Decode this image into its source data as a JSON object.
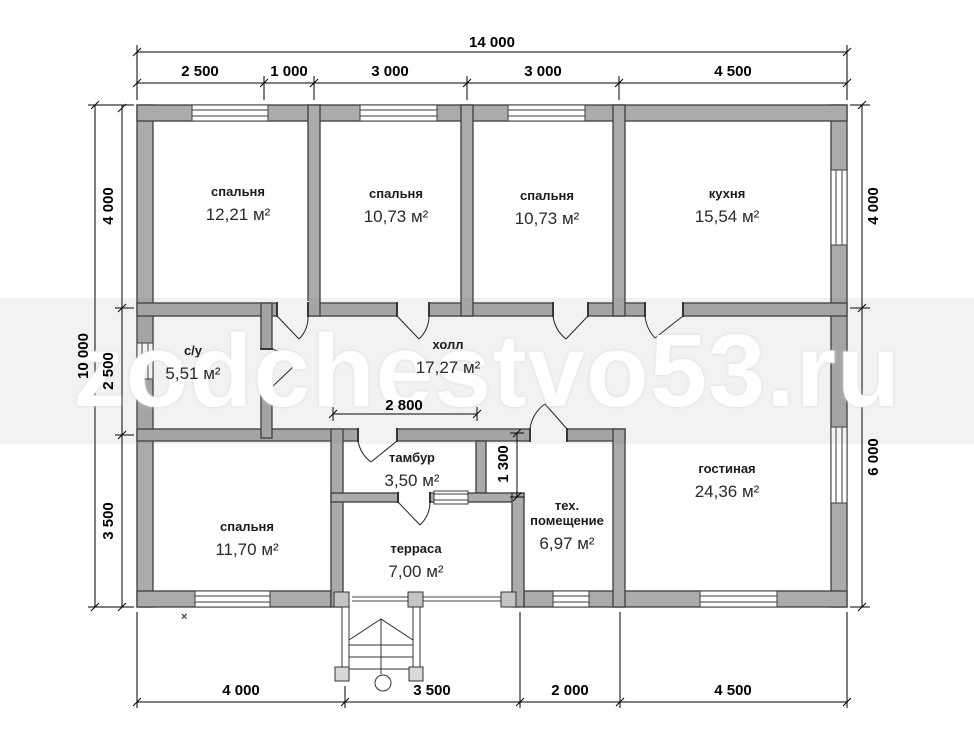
{
  "watermark": "zodchestvo53.ru",
  "marker": "×",
  "dims": {
    "top_total": "14 000",
    "top_segments": [
      "2 500",
      "1 000",
      "3 000",
      "3 000",
      "4 500"
    ],
    "left_total": "10 000",
    "left_segments": [
      "4 000",
      "2 500",
      "3 500"
    ],
    "right_segments": [
      "4 000",
      "6 000"
    ],
    "bottom_segments": [
      "4 000",
      "3 500",
      "2 000",
      "4 500"
    ],
    "interior": {
      "tambour_width": "2 800",
      "passage_depth": "1 300"
    }
  },
  "rooms": [
    {
      "name": "спальня",
      "area": "12,21 м²"
    },
    {
      "name": "спальня",
      "area": "10,73 м²"
    },
    {
      "name": "спальня",
      "area": "10,73 м²"
    },
    {
      "name": "кухня",
      "area": "15,54 м²"
    },
    {
      "name": "с/у",
      "area": "5,51 м²"
    },
    {
      "name": "холл",
      "area": "17,27 м²"
    },
    {
      "name": "тамбур",
      "area": "3,50 м²"
    },
    {
      "name": "спальня",
      "area": "11,70 м²"
    },
    {
      "name": "терраса",
      "area": "7,00 м²"
    },
    {
      "name": "тех. помещение",
      "area": "6,97 м²"
    },
    {
      "name": "гостиная",
      "area": "24,36 м²"
    }
  ]
}
